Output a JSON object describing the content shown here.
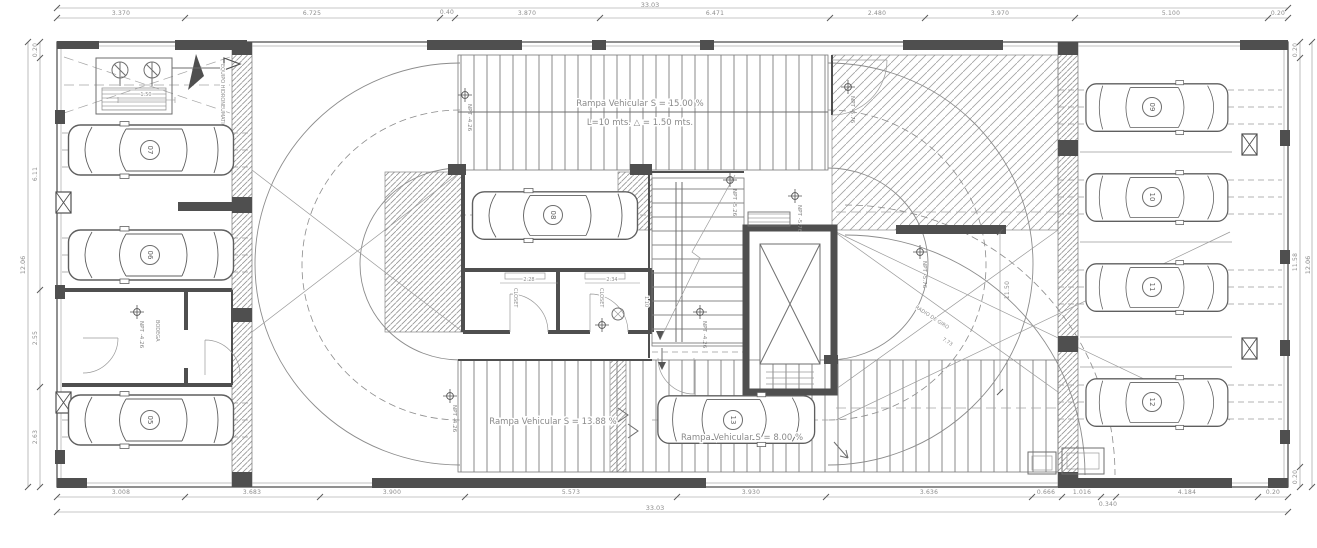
{
  "drawing": {
    "labels": {
      "ramp_top_line1": "Rampa Vehicular   S = 15.00 %",
      "ramp_top_line2": "L=10 mts.  △ = 1.50 mts.",
      "ramp_bottom_left": "Rampa Vehicular   S = 13.88 %",
      "ramp_bottom_right": "Rampa Vehicular   S = 8.00 %",
      "radio_giro": "RADIO DE GIRO",
      "radio_giro_value": "7.73",
      "equipment": "EQUIPO HIDRONEUMATICO",
      "closet_left": "CLOSET",
      "closet_right": "CLOSET",
      "bodega": "BODEGA"
    },
    "levels": [
      {
        "text": "NPT -4.26"
      },
      {
        "text": "NPT -5.76"
      },
      {
        "text": "NPT -5.26"
      },
      {
        "text": "NPT -5.76"
      },
      {
        "text": "NPT -5.76"
      },
      {
        "text": "NPT -4.26"
      },
      {
        "text": "NPT -4.26"
      },
      {
        "text": "NPT -4.26"
      }
    ],
    "cars": [
      {
        "number": "05"
      },
      {
        "number": "06"
      },
      {
        "number": "07"
      },
      {
        "number": "08"
      },
      {
        "number": "09"
      },
      {
        "number": "10"
      },
      {
        "number": "11"
      },
      {
        "number": "12"
      },
      {
        "number": "13"
      }
    ],
    "dims": {
      "top": {
        "total": "33.03",
        "segments": [
          "3.370",
          "6.725",
          "0.40",
          "3.870",
          "6.471",
          "2.480",
          "3.970",
          "5.100",
          "0.20"
        ]
      },
      "bottom": {
        "total": "33.03",
        "segments": [
          "3.008",
          "3.683",
          "3.900",
          "5.573",
          "3.930",
          "3.636",
          "0.666",
          "1.016",
          "0.340",
          "4.184",
          "0.20"
        ]
      },
      "left": {
        "total": "12.06",
        "segments": [
          "0.20",
          "6.11",
          "2.55",
          "2.63"
        ]
      },
      "right": {
        "total": "12.06",
        "segments": [
          "0.20",
          "11.58",
          "0.20"
        ]
      },
      "inner": {
        "h1150": "11.50",
        "d228": "2.28",
        "d234": "2.34",
        "d110": "1.10",
        "d150": "1.50"
      }
    }
  }
}
